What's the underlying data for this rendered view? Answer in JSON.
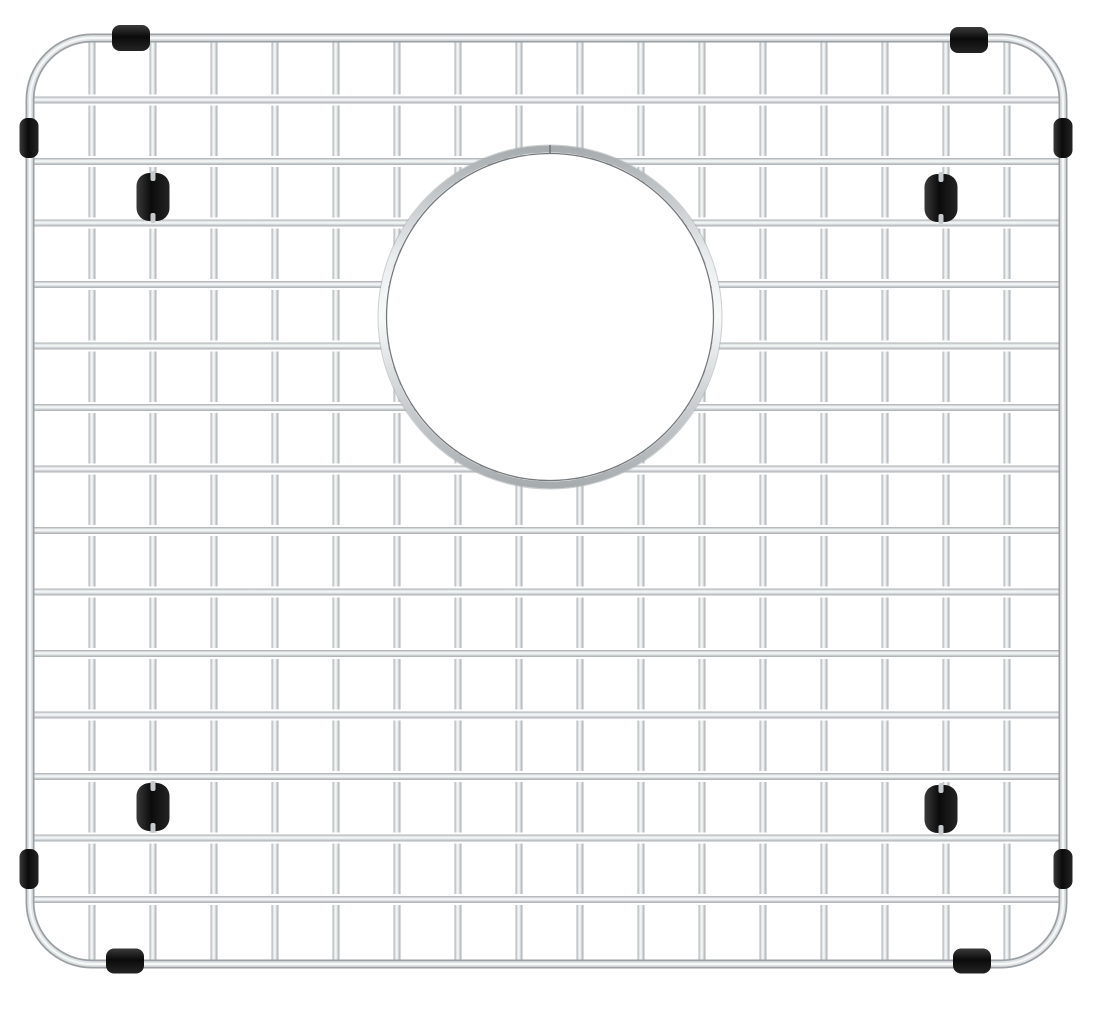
{
  "image": {
    "description": "Stainless steel kitchen sink bottom grid with square wire mesh, rounded-corner outer frame, circular drain opening in the upper middle, and black rubber bumpers and feet",
    "width": 1100,
    "height": 1012,
    "background_color": "#ffffff"
  },
  "scene": {
    "frame": {
      "x": 30,
      "y": 38,
      "width": 1033,
      "height": 926,
      "corner_radius": 62,
      "thickness": 9
    },
    "vertical_wires": {
      "start_x": 92,
      "spacing": 61,
      "count": 16,
      "thickness": 7
    },
    "horizontal_wires": {
      "start_y": 100,
      "spacing": 61.5,
      "count": 14,
      "thickness": 7,
      "halo": 11
    },
    "drain_opening": {
      "cx": 550,
      "cy": 317,
      "radius": 168,
      "ring_thickness": 7,
      "seam_x": 550
    },
    "colors": {
      "background": "#ffffff",
      "wire_edge": "#a7acaf",
      "wire_light": "#e9eced",
      "wire_highlight": "#f8fafa",
      "wire_mid": "#c7cbcd",
      "frame_dark": "#9aa0a3",
      "frame_light": "#dfe3e4",
      "frame_core": "#f6f8f8",
      "ring_inner_line": "#75797c",
      "ring_outer_line": "#aeb3b5",
      "rubber_dark": "#0b0b0b",
      "rubber_sheen": "#3a3a3a"
    },
    "edge_bumpers": [
      {
        "name": "bumper-top-left",
        "cx": 131,
        "cy": 38,
        "w": 38,
        "h": 26,
        "orient": "h"
      },
      {
        "name": "bumper-top-right",
        "cx": 969,
        "cy": 40,
        "w": 38,
        "h": 26,
        "orient": "h"
      },
      {
        "name": "bumper-bottom-left",
        "cx": 125,
        "cy": 961,
        "w": 38,
        "h": 25,
        "orient": "h"
      },
      {
        "name": "bumper-bottom-right",
        "cx": 972,
        "cy": 961,
        "w": 38,
        "h": 25,
        "orient": "h"
      },
      {
        "name": "bumper-left-upper",
        "cx": 29,
        "cy": 138,
        "w": 19,
        "h": 40,
        "orient": "v"
      },
      {
        "name": "bumper-left-lower",
        "cx": 29,
        "cy": 869,
        "w": 19,
        "h": 40,
        "orient": "v"
      },
      {
        "name": "bumper-right-upper",
        "cx": 1063,
        "cy": 138,
        "w": 19,
        "h": 40,
        "orient": "v"
      },
      {
        "name": "bumper-right-lower",
        "cx": 1063,
        "cy": 869,
        "w": 19,
        "h": 40,
        "orient": "v"
      }
    ],
    "feet": [
      {
        "name": "foot-upper-left",
        "cx": 153,
        "cy": 197,
        "w": 33,
        "h": 48
      },
      {
        "name": "foot-upper-right",
        "cx": 941,
        "cy": 198,
        "w": 33,
        "h": 48
      },
      {
        "name": "foot-lower-left",
        "cx": 153,
        "cy": 807,
        "w": 33,
        "h": 48
      },
      {
        "name": "foot-lower-right",
        "cx": 941,
        "cy": 809,
        "w": 33,
        "h": 48
      }
    ]
  }
}
